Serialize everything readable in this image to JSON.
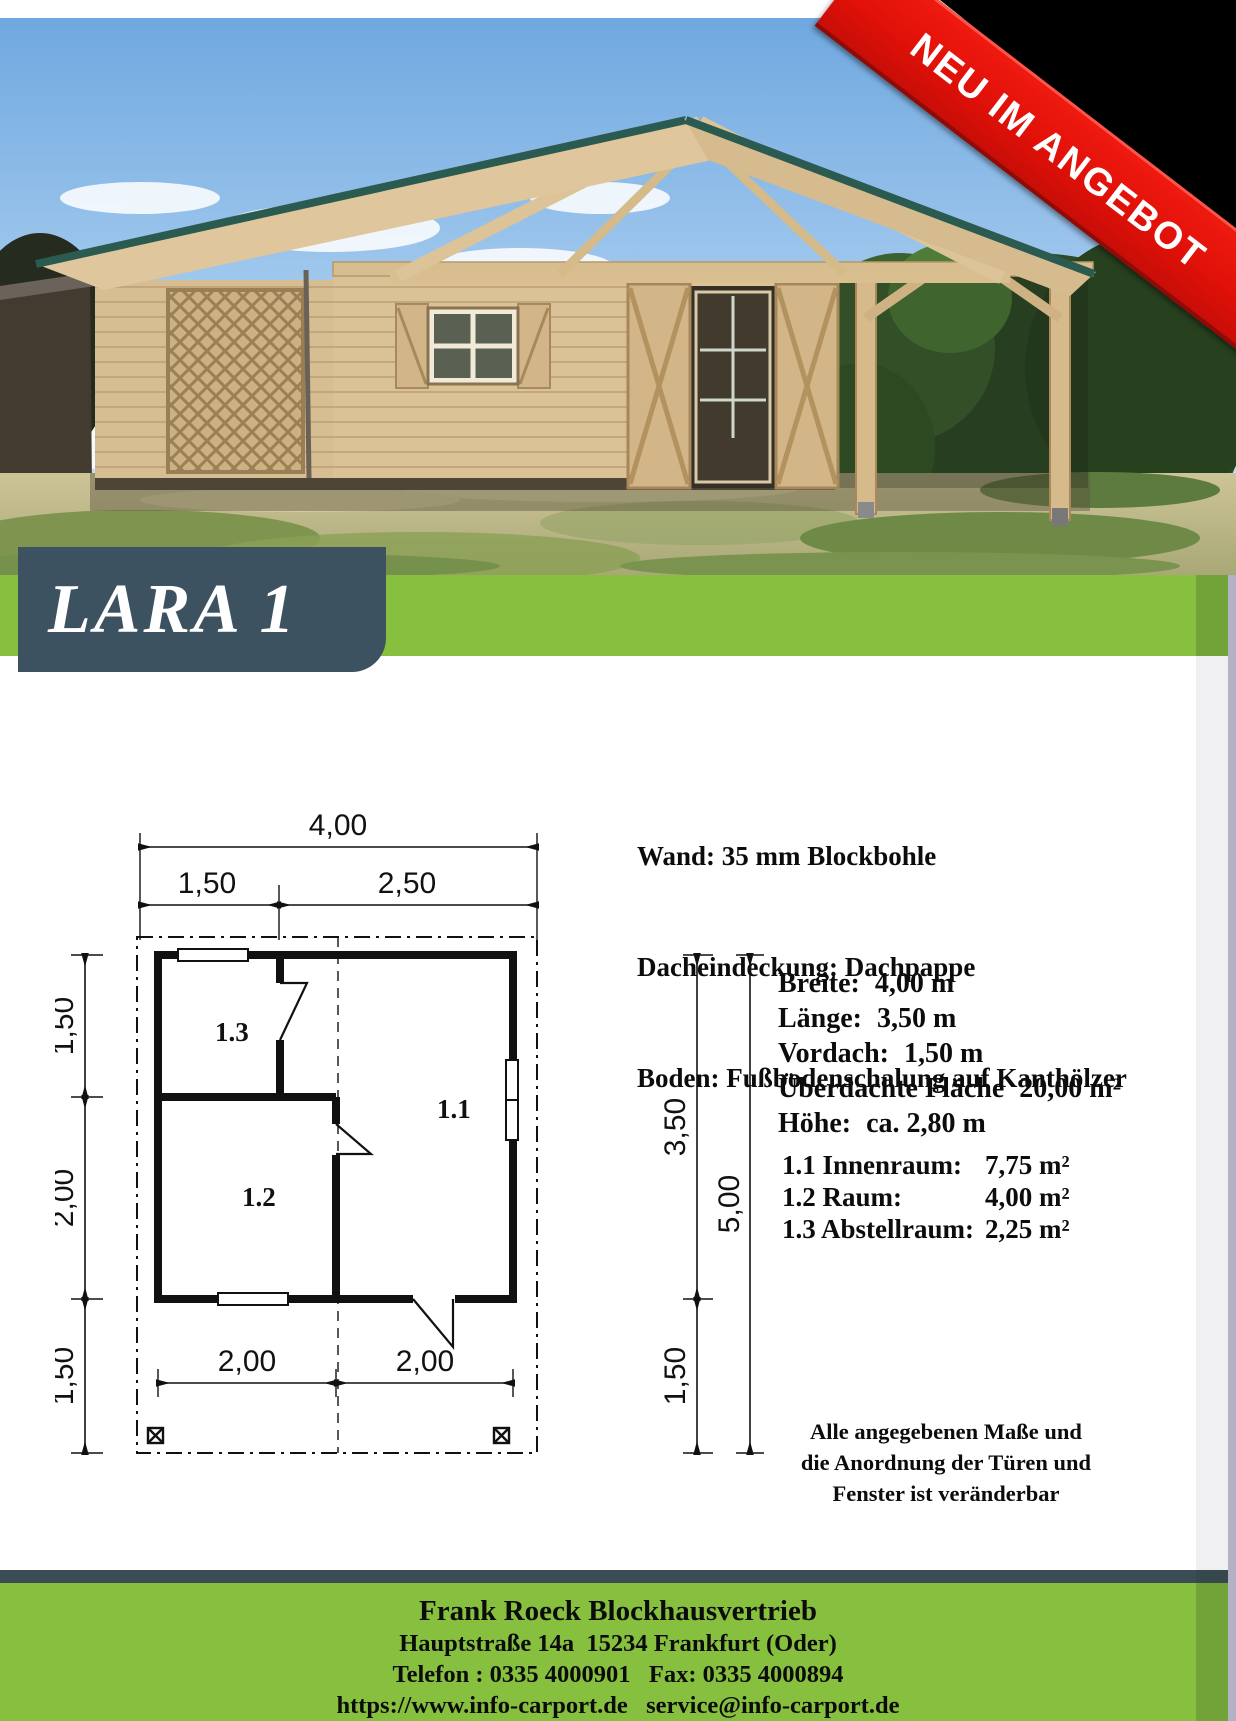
{
  "page": {
    "bg": "#ffffff",
    "accent_green": "#87c03e",
    "accent_slate": "#3d5260",
    "edge_strip": "#b3b1c3"
  },
  "ribbon": {
    "text": "NEU IM ANGEBOT",
    "bg": "#e01109",
    "color": "#ffffff"
  },
  "title": {
    "text": "LARA 1",
    "bg": "#3d5260",
    "color": "#ffffff"
  },
  "specs": {
    "lines": [
      "Wand: 35 mm Blockbohle",
      "Dacheindeckung: Dachpappe",
      "Boden: Fußbodenschalung auf Kanthölzer"
    ]
  },
  "dimensions": [
    {
      "label": "Breite:",
      "value": "4,00 m"
    },
    {
      "label": "Länge:",
      "value": "3,50 m"
    },
    {
      "label": "Vordach:",
      "value": "1,50 m"
    },
    {
      "label": "Überdachte Fläche",
      "value": "20,00 m²"
    },
    {
      "label": "Höhe:",
      "value": "ca. 2,80 m"
    }
  ],
  "rooms": [
    {
      "label": "1.1 Innenraum:",
      "value": "7,75 m²"
    },
    {
      "label": "1.2 Raum:",
      "value": "4,00 m²"
    },
    {
      "label": "1.3 Abstellraum:",
      "value": "2,25 m²"
    }
  ],
  "note": {
    "lines": [
      "Alle angegebenen Maße und",
      "die Anordnung der Türen und",
      "Fenster ist veränderbar"
    ]
  },
  "floorplan": {
    "dims_top": [
      "4,00",
      "1,50",
      "2,50"
    ],
    "dims_left": [
      "1,50",
      "2,00",
      "1,50"
    ],
    "dims_right": [
      "3,50",
      "5,00",
      "1,50"
    ],
    "dims_bottom": [
      "2,00",
      "2,00"
    ],
    "room_labels": [
      "1.3",
      "1.2",
      "1.1"
    ]
  },
  "footer": {
    "lines": [
      "Frank Roeck Blockhausvertrieb",
      "Hauptstraße 14a  15234 Frankfurt (Oder)",
      "Telefon : 0335 4000901   Fax: 0335 4000894",
      "https://www.info-carport.de   service@info-carport.de"
    ]
  }
}
